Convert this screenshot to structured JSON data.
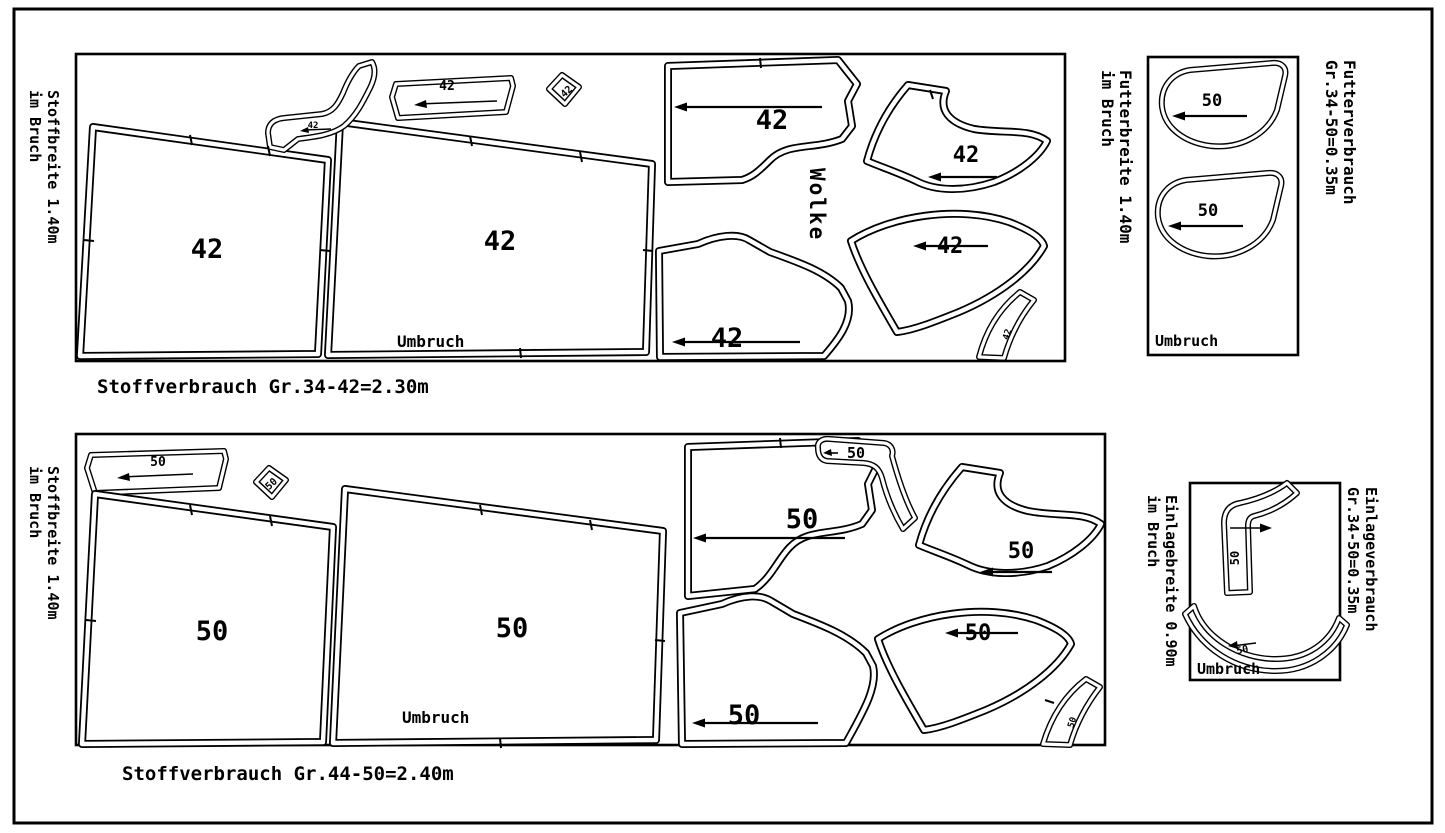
{
  "colors": {
    "ink": "#000000",
    "paper": "#ffffff"
  },
  "layout_42": {
    "side_label": [
      "Stoffbreite 1.40m",
      "im Bruch"
    ],
    "caption": "Stoffverbrauch Gr.34-42=2.30m",
    "fold_label": "Umbruch",
    "model_name": "Wolke",
    "size_label": "42"
  },
  "layout_50": {
    "side_label": [
      "Stoffbreite 1.40m",
      "im Bruch"
    ],
    "caption": "Stoffverbrauch Gr.44-50=2.40m",
    "fold_label": "Umbruch",
    "size_label": "50"
  },
  "lining_panel": {
    "side_label": [
      "Futterbreite 1.40m",
      "im Bruch"
    ],
    "usage_label": [
      "Futterverbrauch",
      "Gr.34-50=0.35m"
    ],
    "fold_label": "Umbruch",
    "size_label": "50"
  },
  "interfacing_panel": {
    "side_label": [
      "Einlagebreite 0.90m",
      "im Bruch"
    ],
    "usage_label": [
      "Einlageverbrauch",
      "Gr.34-50=0.35m"
    ],
    "fold_label": "Umbruch",
    "size_label": "50"
  }
}
